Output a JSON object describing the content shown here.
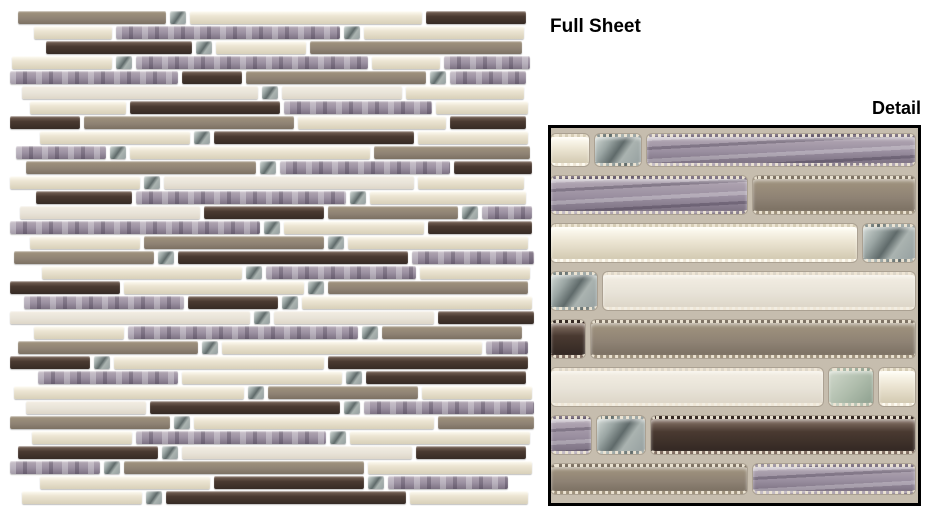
{
  "labels": {
    "full_sheet": "Full Sheet",
    "detail": "Detail"
  },
  "palette": {
    "grout": "#c6bdae",
    "dark_brown": "#4a3a31",
    "cream_gloss": "#ece5d3",
    "white_frosted": "#e8e3d8",
    "lavender_weave": "#9a8fa0",
    "taupe_matte": "#8e8274",
    "silver_mirror": "#96a0a0",
    "green_silver": "#aebcab",
    "detail_border": "#000000"
  },
  "full_sheet": {
    "left": 10,
    "top": 10,
    "width": 525,
    "height": 495,
    "row_height": 15,
    "rows": [
      {
        "o": 8,
        "segs": [
          [
            "T",
            148
          ],
          [
            "S",
            16
          ],
          [
            "C",
            232
          ],
          [
            "B",
            100
          ]
        ]
      },
      {
        "o": 24,
        "segs": [
          [
            "C",
            78
          ],
          [
            "L",
            224
          ],
          [
            "S",
            16
          ],
          [
            "C",
            160
          ]
        ]
      },
      {
        "o": 36,
        "segs": [
          [
            "B",
            146
          ],
          [
            "S",
            16
          ],
          [
            "C",
            90
          ],
          [
            "T",
            212
          ]
        ]
      },
      {
        "o": 2,
        "segs": [
          [
            "C",
            100
          ],
          [
            "S",
            16
          ],
          [
            "L",
            232
          ],
          [
            "C",
            68
          ],
          [
            "L",
            86
          ]
        ]
      },
      {
        "o": 0,
        "segs": [
          [
            "L",
            168
          ],
          [
            "B",
            60
          ],
          [
            "T",
            180
          ],
          [
            "S",
            16
          ],
          [
            "L",
            76
          ]
        ]
      },
      {
        "o": 12,
        "segs": [
          [
            "W",
            236
          ],
          [
            "S",
            16
          ],
          [
            "W",
            120
          ],
          [
            "C",
            118
          ]
        ]
      },
      {
        "o": 20,
        "segs": [
          [
            "C",
            96
          ],
          [
            "B",
            150
          ],
          [
            "L",
            148
          ],
          [
            "C",
            92
          ]
        ]
      },
      {
        "o": 0,
        "segs": [
          [
            "B",
            70
          ],
          [
            "T",
            210
          ],
          [
            "C",
            148
          ],
          [
            "B",
            76
          ]
        ]
      },
      {
        "o": 30,
        "segs": [
          [
            "C",
            150
          ],
          [
            "S",
            16
          ],
          [
            "B",
            200
          ],
          [
            "C",
            110
          ]
        ]
      },
      {
        "o": 6,
        "segs": [
          [
            "L",
            90
          ],
          [
            "S",
            16
          ],
          [
            "C",
            240
          ],
          [
            "T",
            156
          ]
        ]
      },
      {
        "o": 16,
        "segs": [
          [
            "T",
            230
          ],
          [
            "S",
            16
          ],
          [
            "L",
            170
          ],
          [
            "B",
            78
          ]
        ]
      },
      {
        "o": 0,
        "segs": [
          [
            "C",
            130
          ],
          [
            "S",
            16
          ],
          [
            "W",
            250
          ],
          [
            "C",
            106
          ]
        ]
      },
      {
        "o": 26,
        "segs": [
          [
            "B",
            96
          ],
          [
            "L",
            210
          ],
          [
            "S",
            16
          ],
          [
            "C",
            156
          ]
        ]
      },
      {
        "o": 10,
        "segs": [
          [
            "W",
            180
          ],
          [
            "B",
            120
          ],
          [
            "T",
            130
          ],
          [
            "S",
            16
          ],
          [
            "L",
            50
          ]
        ]
      },
      {
        "o": 0,
        "segs": [
          [
            "L",
            250
          ],
          [
            "S",
            16
          ],
          [
            "C",
            140
          ],
          [
            "B",
            104
          ]
        ]
      },
      {
        "o": 20,
        "segs": [
          [
            "C",
            110
          ],
          [
            "T",
            180
          ],
          [
            "S",
            16
          ],
          [
            "C",
            180
          ]
        ]
      },
      {
        "o": 4,
        "segs": [
          [
            "T",
            140
          ],
          [
            "S",
            16
          ],
          [
            "B",
            230
          ],
          [
            "L",
            122
          ]
        ]
      },
      {
        "o": 32,
        "segs": [
          [
            "C",
            200
          ],
          [
            "S",
            16
          ],
          [
            "L",
            150
          ],
          [
            "C",
            110
          ]
        ]
      },
      {
        "o": 0,
        "segs": [
          [
            "B",
            110
          ],
          [
            "C",
            180
          ],
          [
            "S",
            16
          ],
          [
            "T",
            200
          ]
        ]
      },
      {
        "o": 14,
        "segs": [
          [
            "L",
            160
          ],
          [
            "B",
            90
          ],
          [
            "S",
            16
          ],
          [
            "C",
            230
          ]
        ]
      },
      {
        "o": 0,
        "segs": [
          [
            "W",
            240
          ],
          [
            "S",
            16
          ],
          [
            "W",
            160
          ],
          [
            "B",
            96
          ]
        ]
      },
      {
        "o": 24,
        "segs": [
          [
            "C",
            90
          ],
          [
            "L",
            230
          ],
          [
            "S",
            16
          ],
          [
            "T",
            140
          ]
        ]
      },
      {
        "o": 8,
        "segs": [
          [
            "T",
            180
          ],
          [
            "S",
            16
          ],
          [
            "C",
            260
          ],
          [
            "L",
            42
          ]
        ]
      },
      {
        "o": 0,
        "segs": [
          [
            "B",
            80
          ],
          [
            "S",
            16
          ],
          [
            "C",
            210
          ],
          [
            "B",
            200
          ]
        ]
      },
      {
        "o": 28,
        "segs": [
          [
            "L",
            140
          ],
          [
            "C",
            160
          ],
          [
            "S",
            16
          ],
          [
            "B",
            160
          ]
        ]
      },
      {
        "o": 4,
        "segs": [
          [
            "C",
            230
          ],
          [
            "S",
            16
          ],
          [
            "T",
            150
          ],
          [
            "C",
            110
          ]
        ]
      },
      {
        "o": 16,
        "segs": [
          [
            "W",
            120
          ],
          [
            "B",
            190
          ],
          [
            "S",
            16
          ],
          [
            "L",
            170
          ]
        ]
      },
      {
        "o": 0,
        "segs": [
          [
            "T",
            160
          ],
          [
            "S",
            16
          ],
          [
            "C",
            240
          ],
          [
            "T",
            96
          ]
        ]
      },
      {
        "o": 22,
        "segs": [
          [
            "C",
            100
          ],
          [
            "L",
            190
          ],
          [
            "S",
            16
          ],
          [
            "C",
            180
          ]
        ]
      },
      {
        "o": 8,
        "segs": [
          [
            "B",
            140
          ],
          [
            "S",
            16
          ],
          [
            "W",
            230
          ],
          [
            "B",
            110
          ]
        ]
      },
      {
        "o": 0,
        "segs": [
          [
            "L",
            90
          ],
          [
            "S",
            16
          ],
          [
            "T",
            240
          ],
          [
            "C",
            164
          ]
        ]
      },
      {
        "o": 30,
        "segs": [
          [
            "C",
            170
          ],
          [
            "B",
            150
          ],
          [
            "S",
            16
          ],
          [
            "L",
            120
          ]
        ]
      },
      {
        "o": 12,
        "segs": [
          [
            "C",
            120
          ],
          [
            "S",
            16
          ],
          [
            "B",
            240
          ],
          [
            "C",
            118
          ]
        ]
      }
    ]
  },
  "detail": {
    "left": 548,
    "top": 125,
    "width": 373,
    "height": 381,
    "rows": [
      {
        "h": 42,
        "segs": [
          [
            "C",
            38
          ],
          [
            "S",
            46
          ],
          [
            "L",
            268
          ]
        ]
      },
      {
        "h": 48,
        "segs": [
          [
            "L",
            196
          ],
          [
            "T",
            162
          ]
        ]
      },
      {
        "h": 48,
        "segs": [
          [
            "C",
            306
          ],
          [
            "S",
            52
          ]
        ]
      },
      {
        "h": 48,
        "segs": [
          [
            "S",
            46
          ],
          [
            "W",
            312
          ]
        ]
      },
      {
        "h": 48,
        "segs": [
          [
            "B",
            34
          ],
          [
            "T",
            324
          ]
        ]
      },
      {
        "h": 48,
        "segs": [
          [
            "W",
            272
          ],
          [
            "G",
            44
          ],
          [
            "C",
            36
          ]
        ]
      },
      {
        "h": 48,
        "segs": [
          [
            "L",
            40
          ],
          [
            "S",
            48
          ],
          [
            "B",
            264
          ]
        ]
      },
      {
        "h": 40,
        "segs": [
          [
            "T",
            196
          ],
          [
            "L",
            162
          ]
        ]
      }
    ]
  }
}
